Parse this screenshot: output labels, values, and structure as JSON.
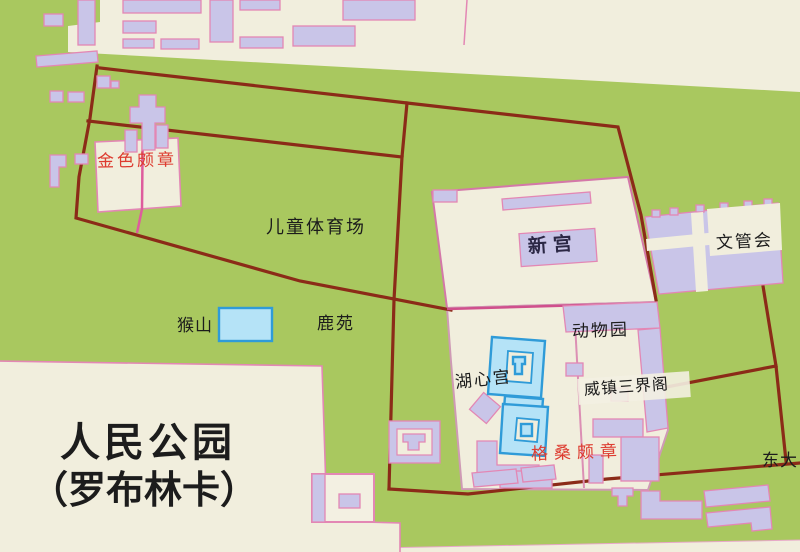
{
  "map": {
    "park_title_line1": "人民公园",
    "park_title_line2": "（罗布林卡）",
    "labels": {
      "jinse_phodrang": "金色颇章",
      "ertong_stadium": "儿童体育场",
      "xingong": "新宫",
      "wenguanhui": "文管会",
      "houshan": "猴山",
      "luyuan": "鹿苑",
      "dongwuyuan": "动物园",
      "huxingong": "湖心宫",
      "weizhen_sanjiege": "威镇三界阁",
      "gesang_phodrang": "格桑颇章",
      "dongda_gate": "东大"
    },
    "colors": {
      "park_green": "#a9c85f",
      "paper_cream": "#f1eedd",
      "building_lavender": "#c9c5e8",
      "building_outline_pink": "#e387b4",
      "boundary_dark_red": "#8b2b18",
      "road_pink": "#de5c9d",
      "path_pink_light": "#dc8fb4",
      "compound_outline": "#d478a8",
      "water_fill": "#b5e3f7",
      "water_outline": "#2f9bd8",
      "label_red": "#dd3b2f",
      "label_black": "#1c1c1c",
      "label_dark_navy": "#2b2745",
      "white_cream": "#f3f0e2"
    }
  }
}
